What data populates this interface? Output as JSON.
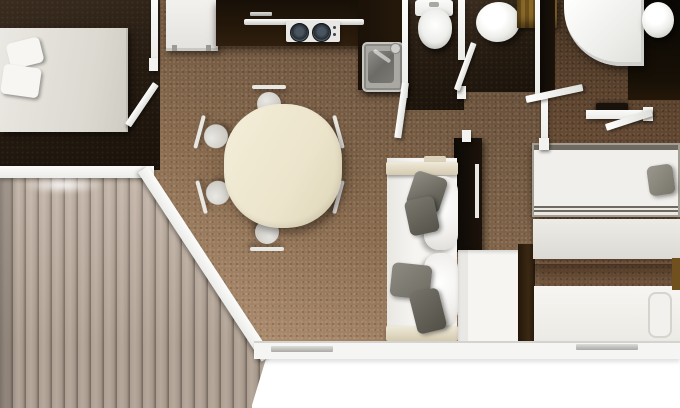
{
  "scene": {
    "title": "Holiday lodge floor plan - top-down 3D render",
    "rooms": {
      "master_bedroom": {
        "label": "Master bedroom"
      },
      "kitchen": {
        "label": "Kitchen"
      },
      "wc": {
        "label": "WC"
      },
      "bathroom": {
        "label": "Bathroom"
      },
      "shower_room": {
        "label": "Shower room"
      },
      "living_dining": {
        "label": "Living and dining area"
      },
      "twin_bedroom": {
        "label": "Twin bedroom"
      },
      "terrace": {
        "label": "Wooden terrace deck"
      }
    },
    "furniture": {
      "double_bed": {
        "label": "Double bed with two pillows"
      },
      "tall_cabinet": {
        "label": "Tall cabinet / fridge"
      },
      "kitchen_counter": {
        "label": "L-shaped kitchen counter"
      },
      "hob": {
        "label": "Two-burner hob"
      },
      "kitchen_sink": {
        "label": "Kitchen sink with tap"
      },
      "toilet": {
        "label": "Toilet"
      },
      "washbasin": {
        "label": "Round washbasin"
      },
      "corner_shower": {
        "label": "Corner shower cubicle"
      },
      "shower_basin": {
        "label": "Round basin on vanity"
      },
      "bathroom_cabinet": {
        "label": "Wooden bathroom cabinet"
      },
      "dining_table": {
        "label": "Oval dining table"
      },
      "dining_chair": {
        "label": "Dining chair"
      },
      "sofa": {
        "label": "Sofa with white cushions and grey throw pillows"
      },
      "media_wall": {
        "label": "Dark media wall"
      },
      "storage_unit": {
        "label": "White storage unit"
      },
      "wardrobe": {
        "label": "Wardrobe"
      },
      "single_bed_top": {
        "label": "Single bed with grey pillow"
      },
      "single_bed_bottom": {
        "label": "Single bed"
      },
      "patio_door_handle": {
        "label": "Patio door handle"
      },
      "window_handle": {
        "label": "Window handle"
      }
    },
    "palette": {
      "carpet_light": "#b69574",
      "carpet_dark": "#55402e",
      "bedroom_floor_dark": "#241a10",
      "deck_plank": "#b1a294",
      "deck_gap": "#7d7065",
      "counter_dark": "#20150a",
      "wall_white": "#f5f5f3",
      "wall_black": "#0c0906",
      "cushion_grey": "#6b6860",
      "table_cream": "#ece4cb",
      "cabinet_gold": "#8a6a28"
    }
  }
}
